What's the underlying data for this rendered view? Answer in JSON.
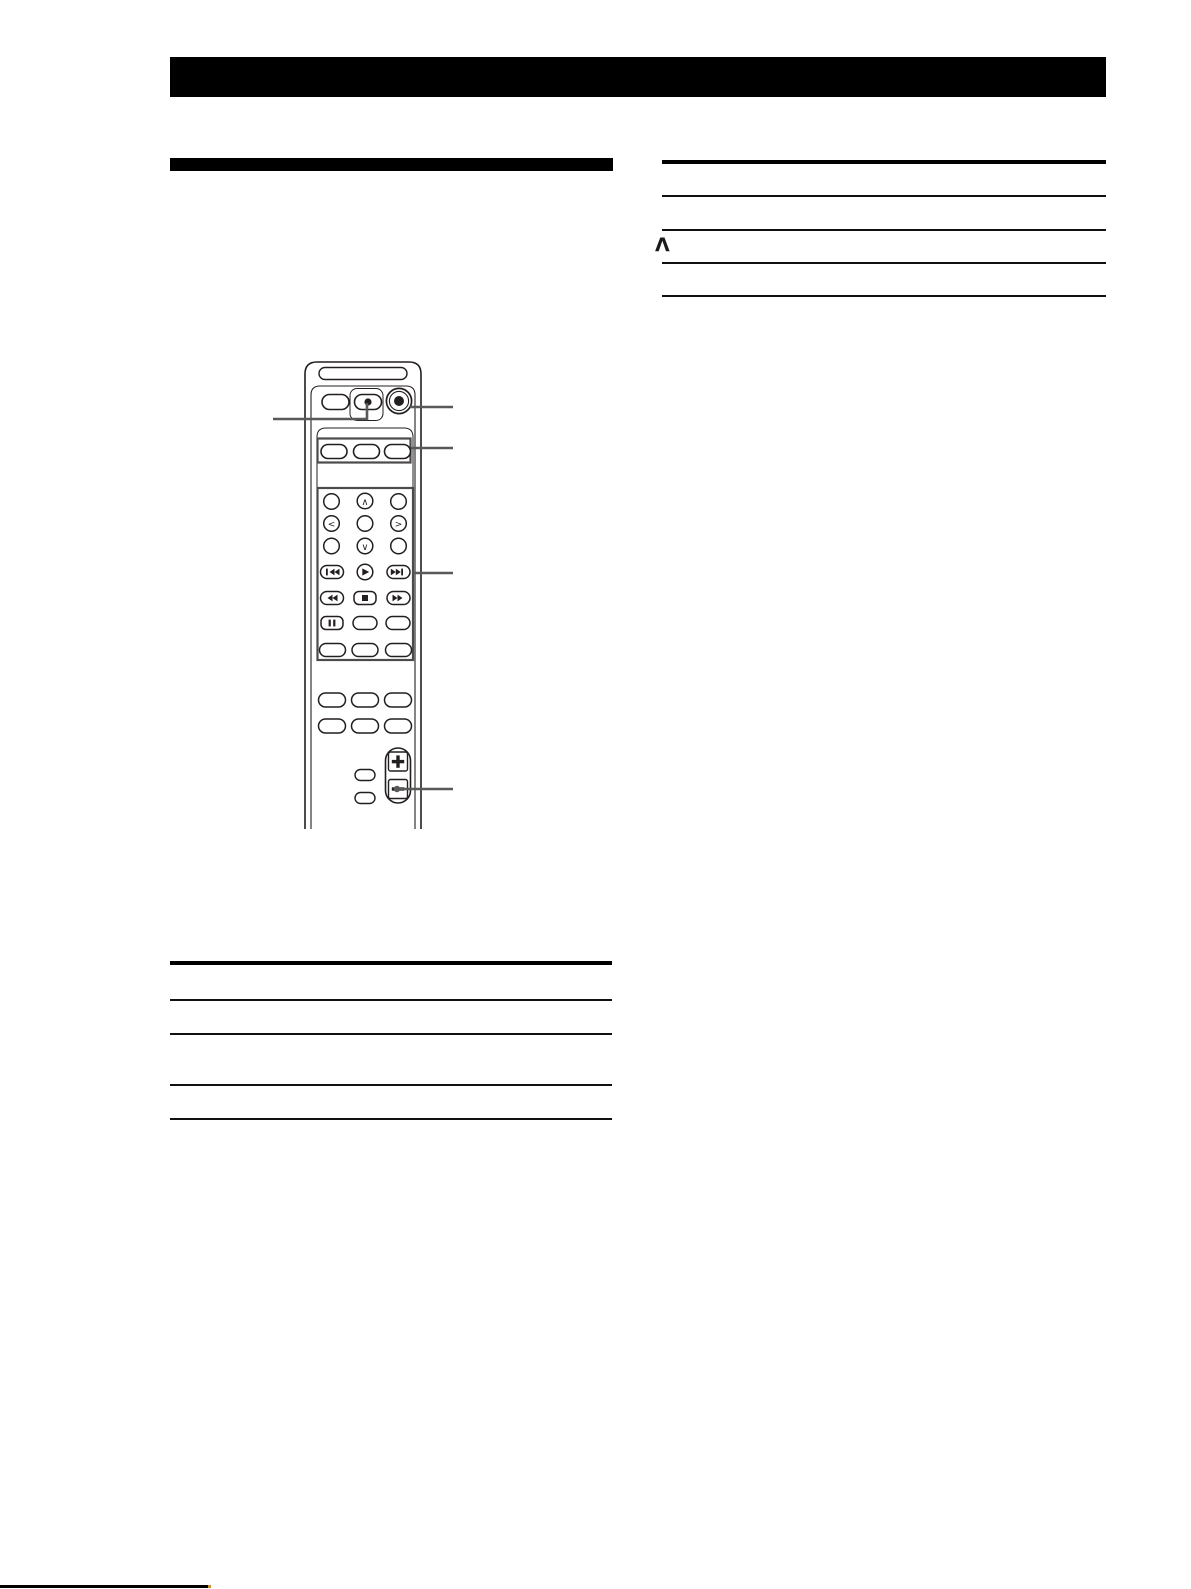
{
  "tables": {
    "right": {
      "rows": [
        "",
        "",
        "Λ",
        ""
      ]
    },
    "left": {
      "rows": [
        "",
        "",
        "",
        ""
      ]
    }
  },
  "remote": {
    "nav_labels": {
      "up": "∧",
      "down": "∨",
      "left": "<",
      "right": ">"
    }
  },
  "icons": {
    "power": "power-button-icon",
    "record_dot": "record-dot-icon",
    "prev": "previous-track-icon",
    "play": "play-icon",
    "next": "next-track-icon",
    "rewind": "rewind-icon",
    "stop": "stop-icon",
    "fast_forward": "fast-forward-icon",
    "pause": "pause-icon",
    "volume_plus": "plus-icon",
    "volume_minus": "minus-icon"
  },
  "colors": {
    "ink": "#231f20",
    "group_box": "#4b4b4d",
    "callout": "#58595b",
    "footer_dot": "#c8922e",
    "background": "#ffffff"
  }
}
